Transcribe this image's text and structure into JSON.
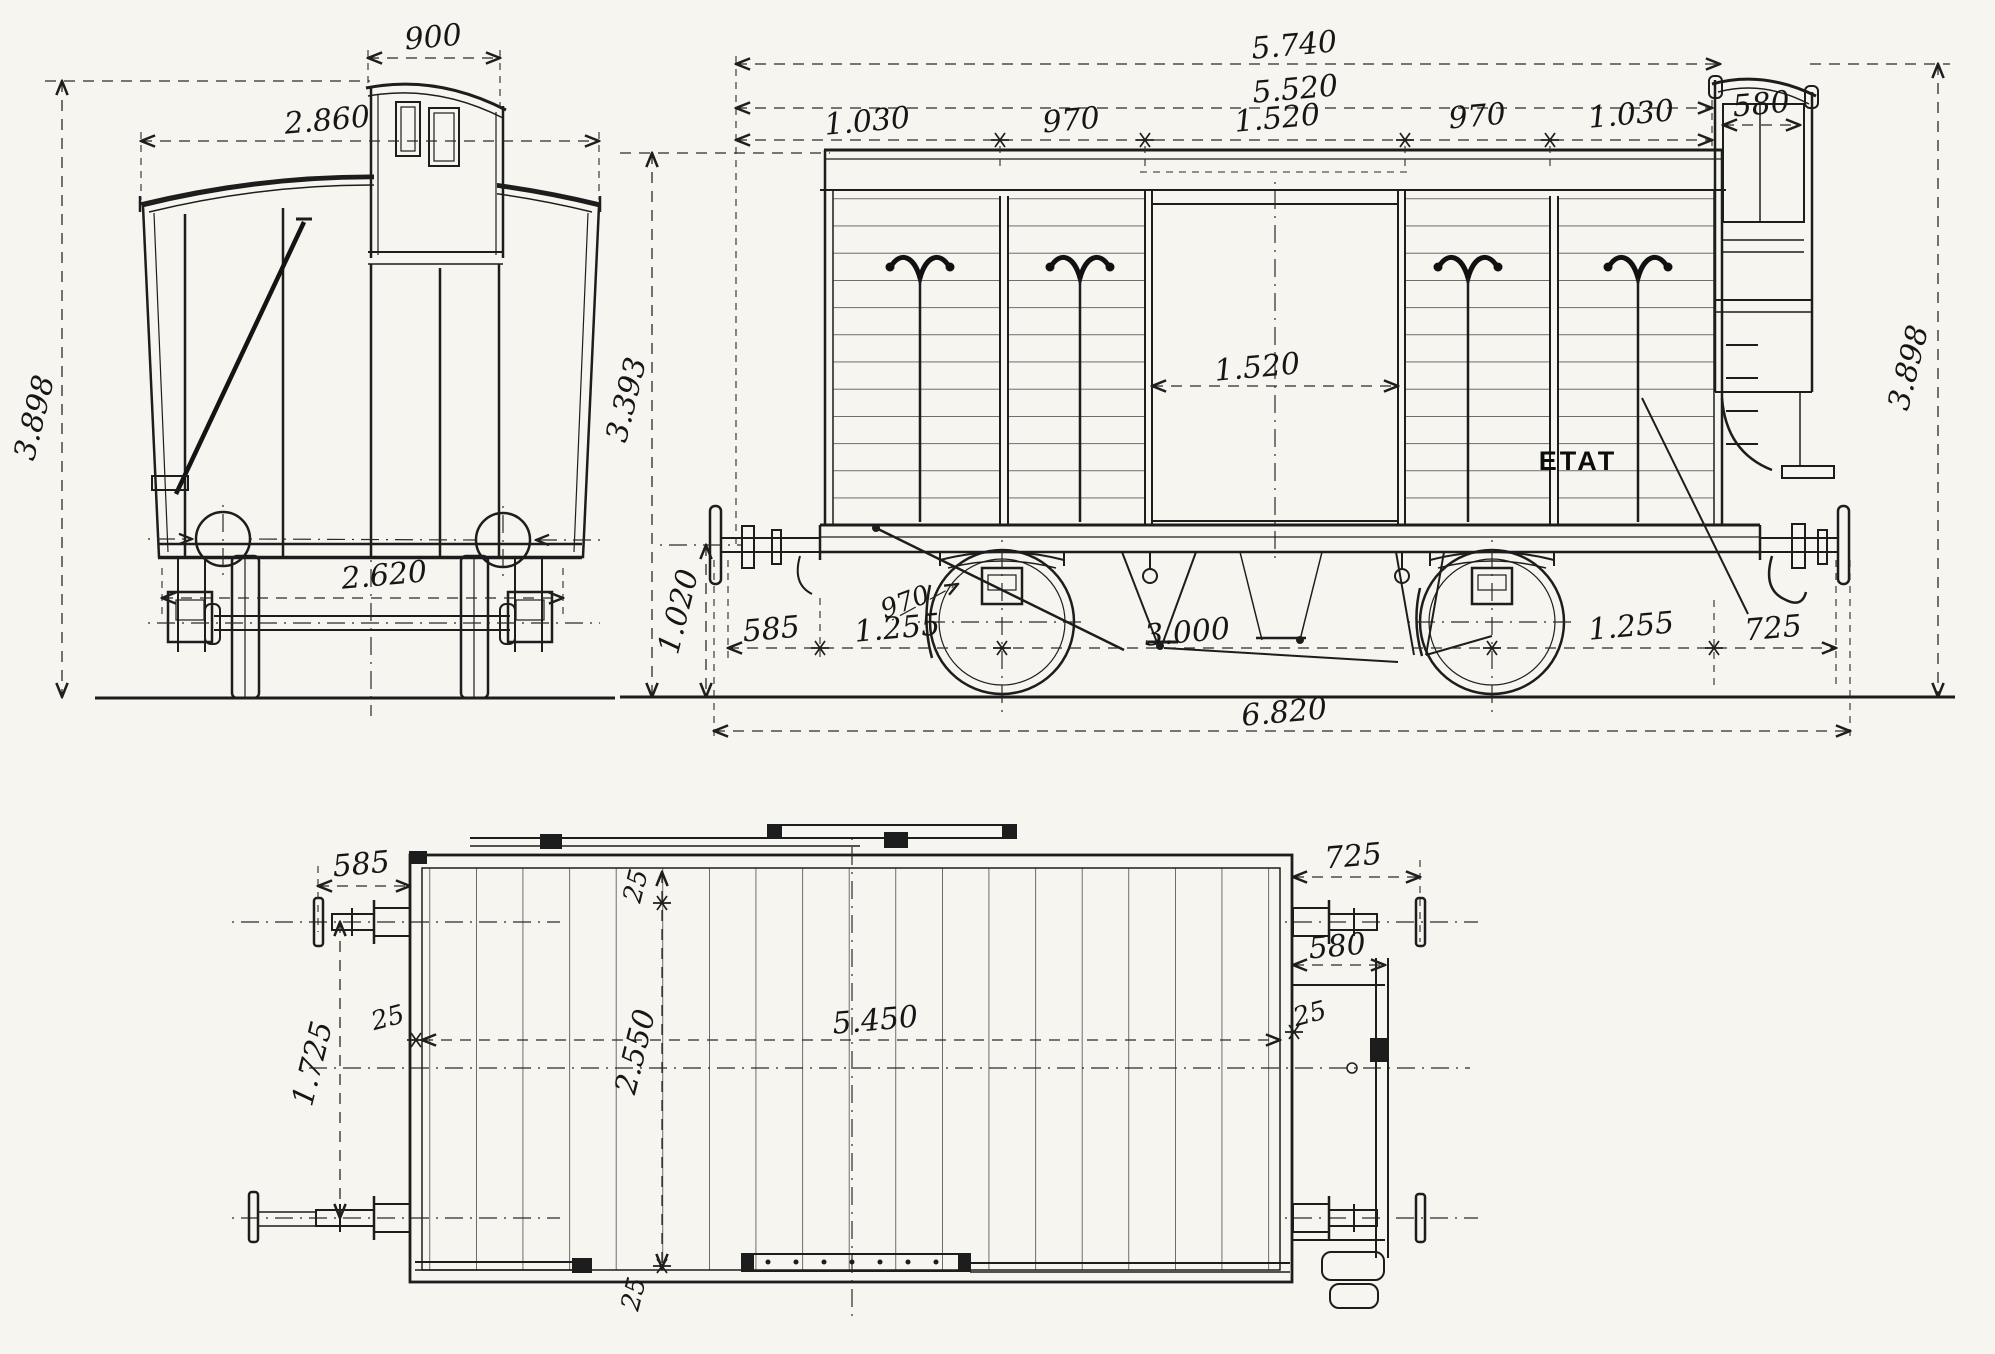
{
  "meta": {
    "drawing_type": "railway-van-three-view-technical-drawing",
    "paper_color": "#f6f5f0",
    "ink_color": "#1d1d1d",
    "marking": "ETAT"
  },
  "end_view": {
    "dims": {
      "lookout_width": "900",
      "body_width": "2.860",
      "overall_height": "3.898",
      "axle_width": "2.620"
    }
  },
  "side_view": {
    "marking": "ETAT",
    "dims": {
      "length_over_ends": "5.740",
      "body_length": "5.520",
      "bay1": "1.030",
      "bay2": "970",
      "bay3": "1.520",
      "bay4": "970",
      "bay5": "1.030",
      "lookout_width": "580",
      "overall_height": "3.898",
      "body_height": "3.393",
      "buffer_height": "1.020",
      "door_opening": "1.520",
      "wheel_diameter": "970",
      "buffer_to_headstock": "585",
      "headstock_to_wheel": "1.255",
      "wheelbase": "3.000",
      "wheel_to_end": "1.255",
      "end_overhang": "725",
      "length_over_buffers": "6.820"
    }
  },
  "plan_view": {
    "dims": {
      "buffer_projection_left": "585",
      "wall_thickness_top": "25",
      "interior_length": "5.450",
      "interior_width": "2.550",
      "buffer_spacing": "1.725",
      "wall_thickness_left": "25",
      "wall_thickness_bottom": "25",
      "wall_thickness_right": "25",
      "platform_depth": "580",
      "buffer_projection_right": "725"
    }
  }
}
